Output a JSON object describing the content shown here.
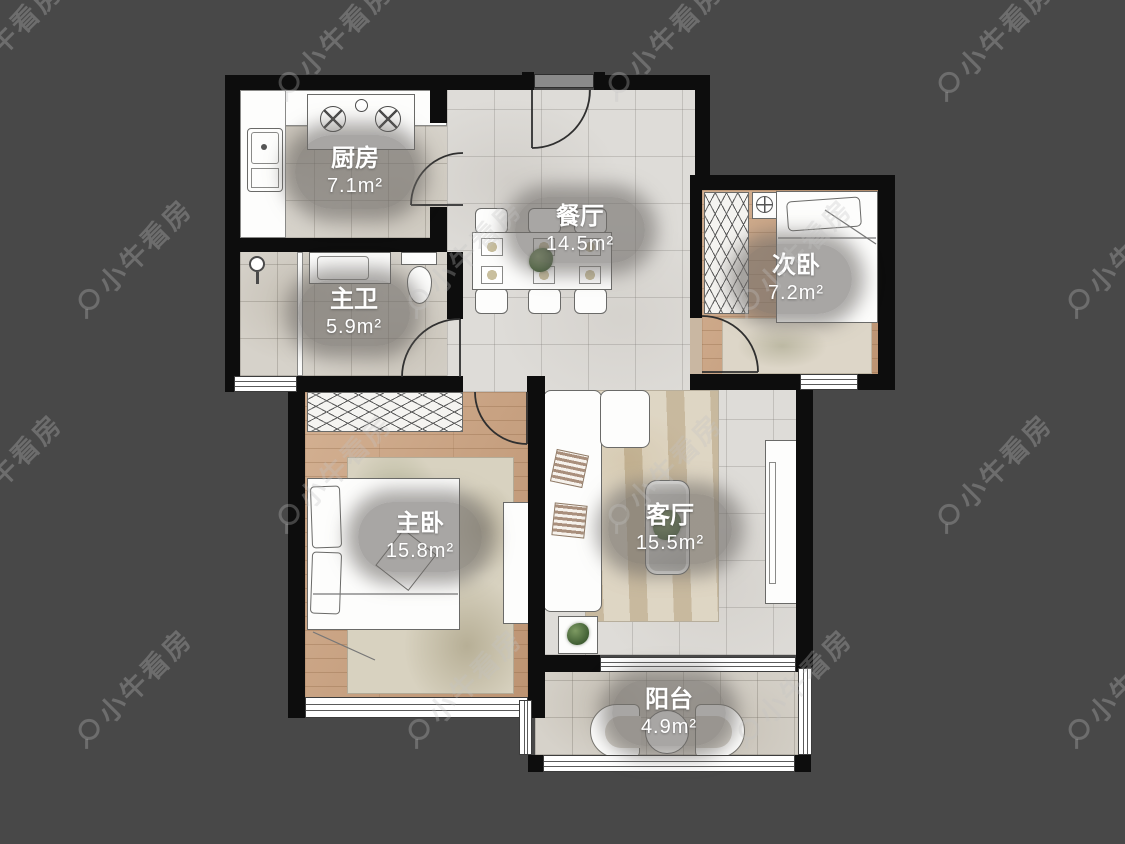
{
  "watermark": {
    "text": "小牛看房"
  },
  "rooms": [
    {
      "key": "kitchen",
      "name": "厨房",
      "area": "7.1m²"
    },
    {
      "key": "dining-room",
      "name": "餐厅",
      "area": "14.5m²"
    },
    {
      "key": "second-bedroom",
      "name": "次卧",
      "area": "7.2m²"
    },
    {
      "key": "master-bathroom",
      "name": "主卫",
      "area": "5.9m²"
    },
    {
      "key": "master-bedroom",
      "name": "主卧",
      "area": "15.8m²"
    },
    {
      "key": "living-room",
      "name": "客厅",
      "area": "15.5m²"
    },
    {
      "key": "balcony",
      "name": "阳台",
      "area": "4.9m²"
    }
  ],
  "colors": {
    "background": "#484848",
    "wall": "#0d0d0d",
    "wood_floor": "#c59d7d",
    "tile_floor": "#d6d2ca",
    "marble_floor": "#dedcd8",
    "label_bubble": "#706d69",
    "label_text": "#ffffff",
    "watermark": "#c3c3c3"
  }
}
